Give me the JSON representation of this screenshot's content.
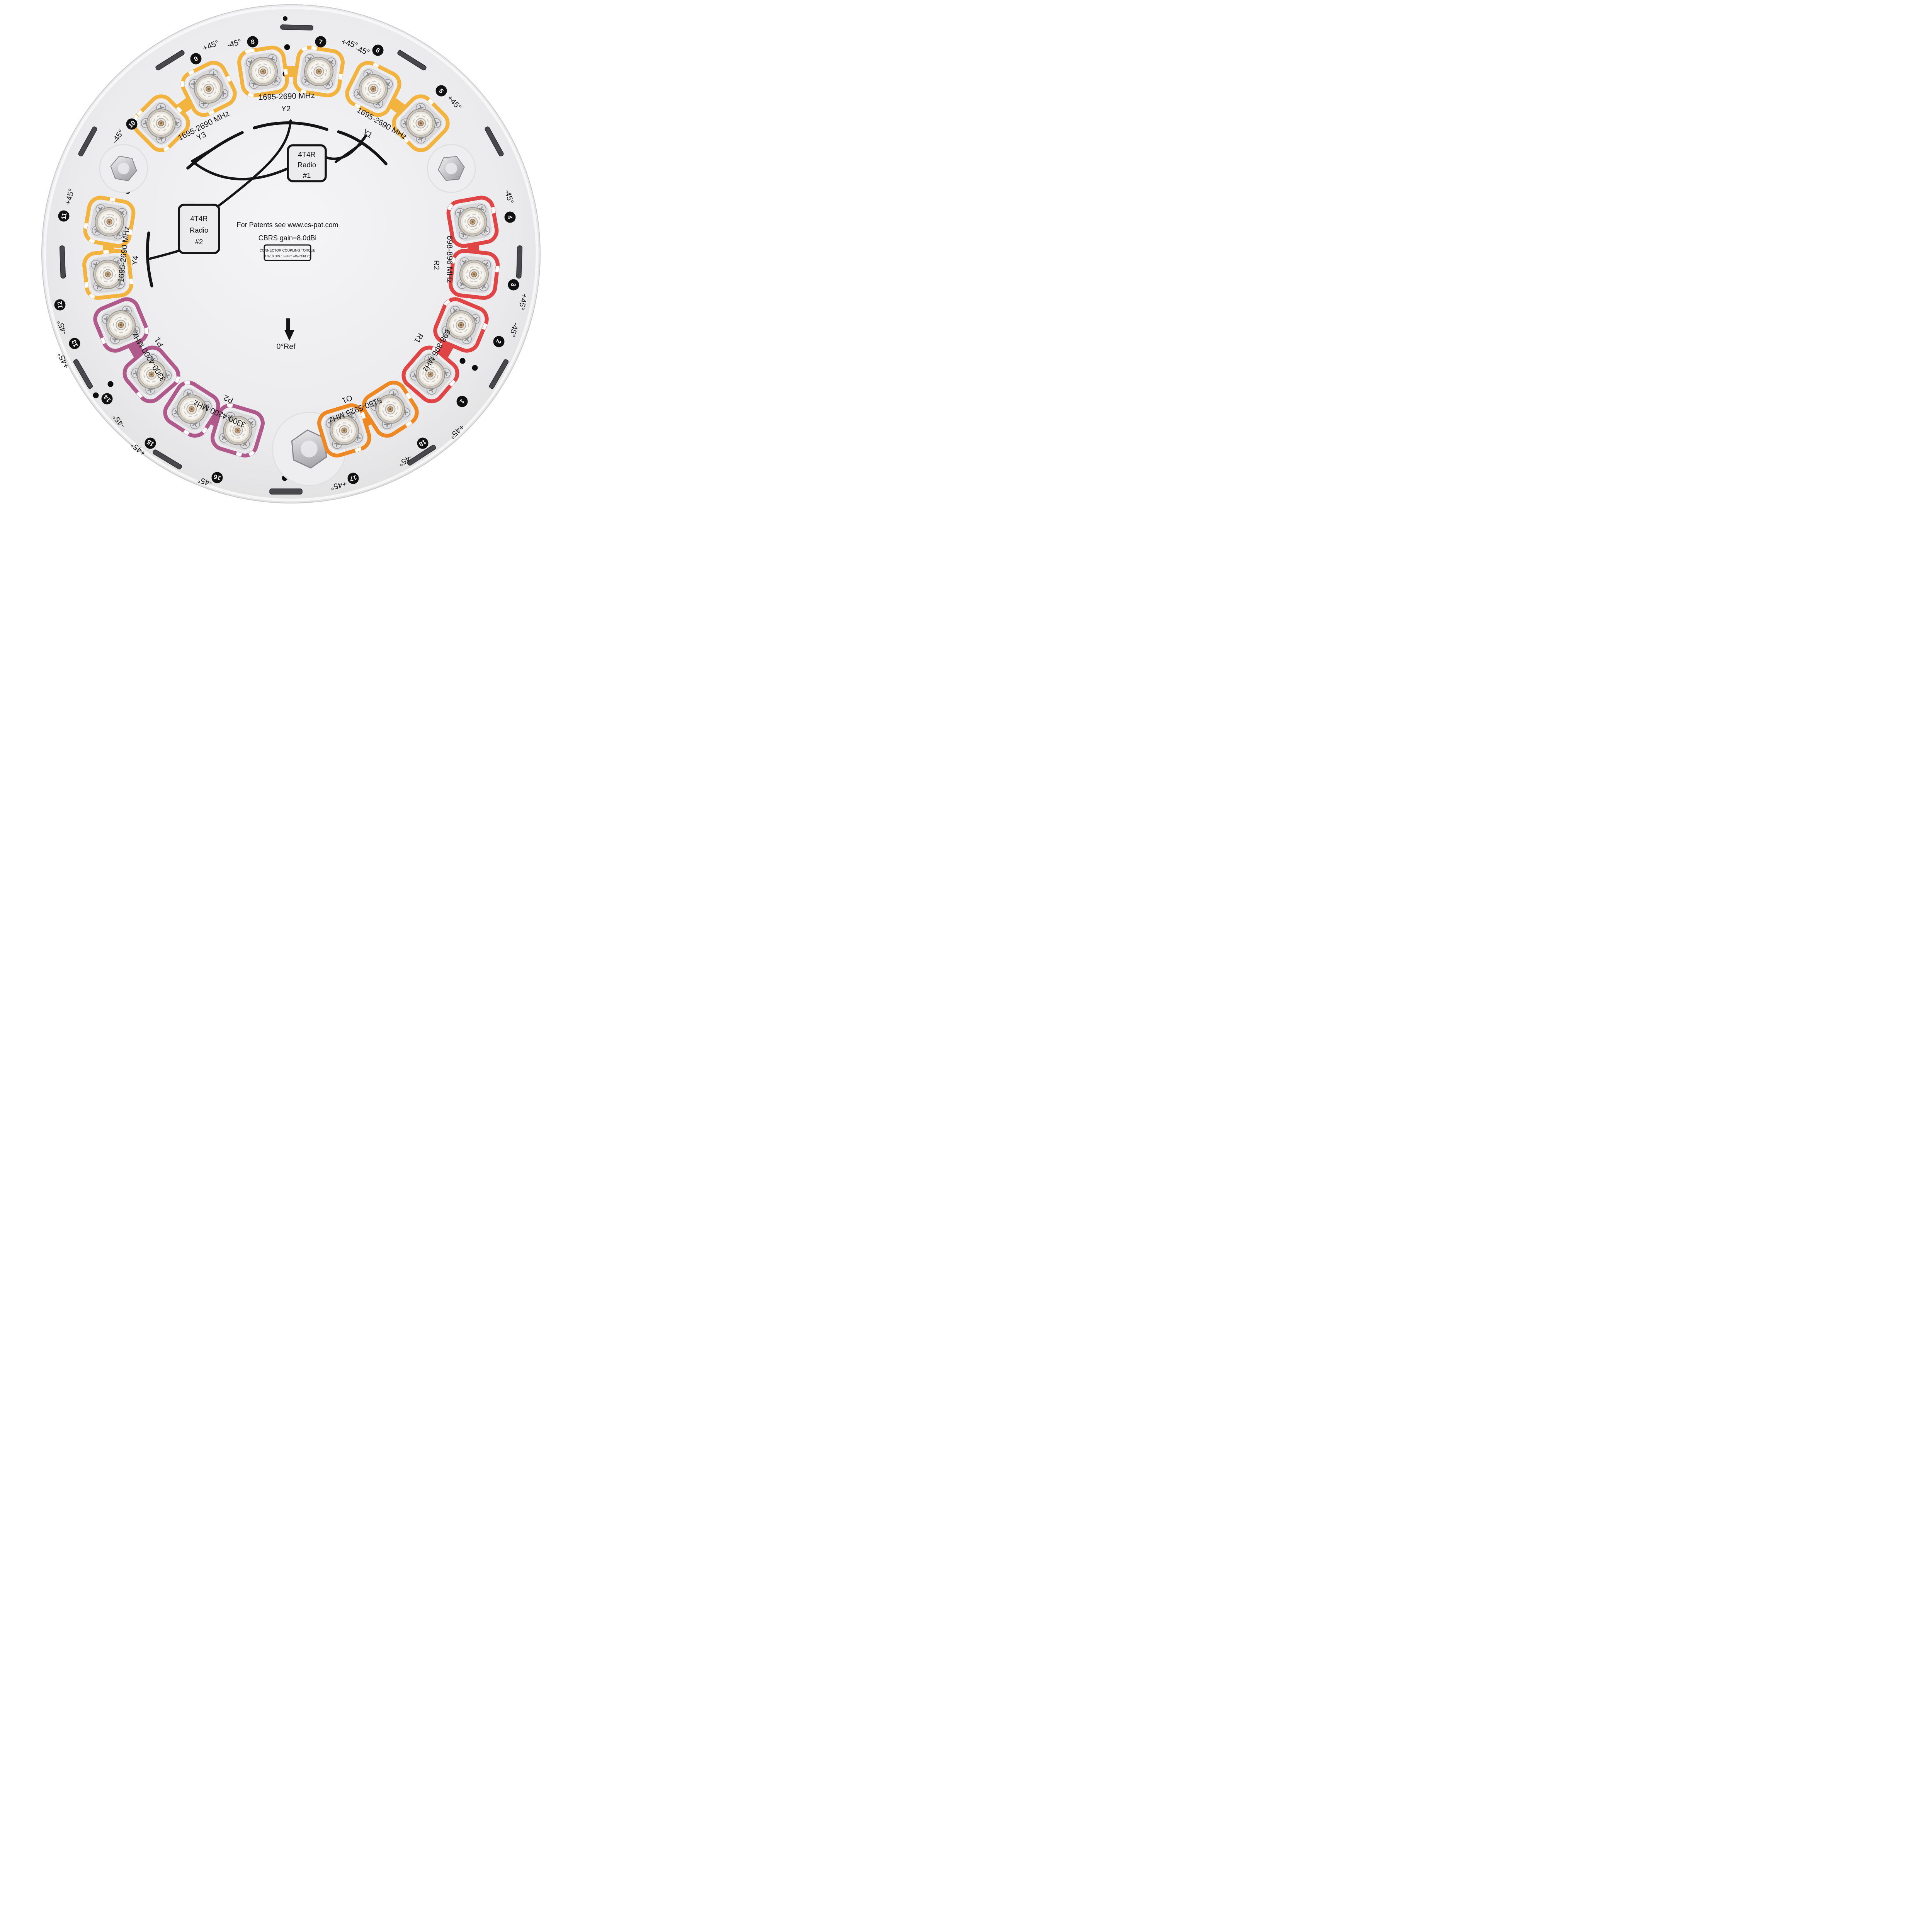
{
  "title": "Antenna bottom connector panel",
  "colors": {
    "yellow": "#F2B43E",
    "red": "#E04444",
    "purple": "#B05A8C",
    "orange": "#EE8822",
    "disc": "#ECECEE",
    "badge": "#101010"
  },
  "center": {
    "patents": "For Patents see www.cs-pat.com",
    "gain": "CBRS gain=8.0dBi",
    "torque_line1": "CONNECTOR COUPLING TORQUE",
    "torque_line2": "4.3-10 DIN : 5-8Nm (45-71lbf in)",
    "ref_label": "0°Ref"
  },
  "radios": [
    {
      "line1": "4T4R",
      "line2": "Radio",
      "line3": "#1"
    },
    {
      "line1": "4T4R",
      "line2": "Radio",
      "line3": "#2"
    }
  ],
  "groups": [
    {
      "label": "Y1",
      "freq": "1695-2690 MHz",
      "color": "#F2B43E",
      "ports": "5-6"
    },
    {
      "label": "Y2",
      "freq": "1695-2690 MHz",
      "color": "#F2B43E",
      "ports": "7-8"
    },
    {
      "label": "Y3",
      "freq": "1695-2690 MHz",
      "color": "#F2B43E",
      "ports": "9-10"
    },
    {
      "label": "Y4",
      "freq": "1695-2690 MHz",
      "color": "#F2B43E",
      "ports": "11-12"
    },
    {
      "label": "R1",
      "freq": "698-896 MHz",
      "color": "#E04444",
      "ports": "1-2"
    },
    {
      "label": "R2",
      "freq": "698-896 MHz",
      "color": "#E04444",
      "ports": "3-4"
    },
    {
      "label": "P1",
      "freq": "3300-4200 MHz",
      "color": "#B05A8C",
      "ports": "13-14"
    },
    {
      "label": "P2",
      "freq": "3300-4200 MHz",
      "color": "#B05A8C",
      "ports": "15-16"
    },
    {
      "label": "O1",
      "freq": "5150-5925 MHz",
      "color": "#EE8822",
      "ports": "17-18"
    }
  ],
  "ports": [
    {
      "number": "1",
      "polarization": "+45°"
    },
    {
      "number": "2",
      "polarization": "-45°"
    },
    {
      "number": "3",
      "polarization": "+45°"
    },
    {
      "number": "4",
      "polarization": "-45°"
    },
    {
      "number": "5",
      "polarization": "+45°"
    },
    {
      "number": "6",
      "polarization": "-45°"
    },
    {
      "number": "7",
      "polarization": "+45°"
    },
    {
      "number": "8",
      "polarization": "-45°"
    },
    {
      "number": "9",
      "polarization": "+45°"
    },
    {
      "number": "10",
      "polarization": "-45°"
    },
    {
      "number": "11",
      "polarization": "+45°"
    },
    {
      "number": "12",
      "polarization": "-45°"
    },
    {
      "number": "13",
      "polarization": "+45°"
    },
    {
      "number": "14",
      "polarization": "-45°"
    },
    {
      "number": "15",
      "polarization": "+45°"
    },
    {
      "number": "16",
      "polarization": "-45°"
    },
    {
      "number": "17",
      "polarization": "+45°"
    },
    {
      "number": "18",
      "polarization": "-45°"
    }
  ]
}
